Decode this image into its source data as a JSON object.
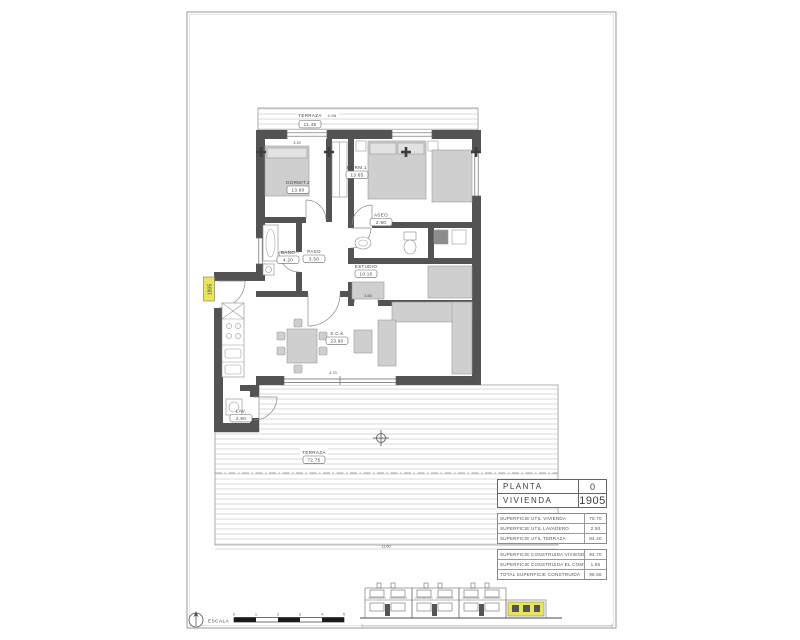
{
  "plan": {
    "rooms": [
      {
        "label": "TERRAZA",
        "area": "11.45"
      },
      {
        "label": "DORMIT.2",
        "area": "13.60"
      },
      {
        "label": "DORM.1",
        "area": "13.65"
      },
      {
        "label": "ASEO",
        "area": "2.90"
      },
      {
        "label": "BAÑO",
        "area": "4.20"
      },
      {
        "label": "PASO",
        "area": "3.50"
      },
      {
        "label": "ESTUDIO",
        "area": "10.10"
      },
      {
        "label": "S.C.K",
        "area": "23.90"
      },
      {
        "label": "LAV.",
        "area": "2.90"
      },
      {
        "label": "TERRAZA",
        "area": "72.75"
      }
    ],
    "dimensions": {
      "terraza_top_width": "4.95",
      "dorm2_width": "3.20",
      "estudio_width": "3.60",
      "living_width": "4.70",
      "deck_right_depth": "5.70",
      "deck_bottom_width": "11.60"
    },
    "entry_marker": "1905"
  },
  "title_block": {
    "planta_label": "PLANTA",
    "planta_value": "0",
    "vivienda_label": "VIVIENDA",
    "vivienda_value": "1905",
    "util_rows": [
      {
        "label": "SUPERFICIE UTIL VIVIENDA",
        "value": "75.70"
      },
      {
        "label": "SUPERFICIE UTIL LAVADERO",
        "value": "2.90"
      },
      {
        "label": "SUPERFICIE UTIL TERRAZA",
        "value": "84.20"
      }
    ],
    "construida_rows": [
      {
        "label": "SUPERFICIE CONSTRUIDA VIVIENDA",
        "value": "94.70"
      },
      {
        "label": "SUPERFICIE CONSTRUIDA EL.COMUNES",
        "value": "1.85"
      },
      {
        "label": "TOTAL SUPERFICIE CONSTRUIDA",
        "value": "96.55"
      }
    ]
  },
  "footer": {
    "scale_label": "ESCALA",
    "scale_ticks": [
      "0",
      "1",
      "2",
      "3",
      "4",
      "5"
    ]
  },
  "colors": {
    "wall": "#535353",
    "highlight_yellow": "#e9e45e",
    "furniture": "#cfcfcf"
  }
}
